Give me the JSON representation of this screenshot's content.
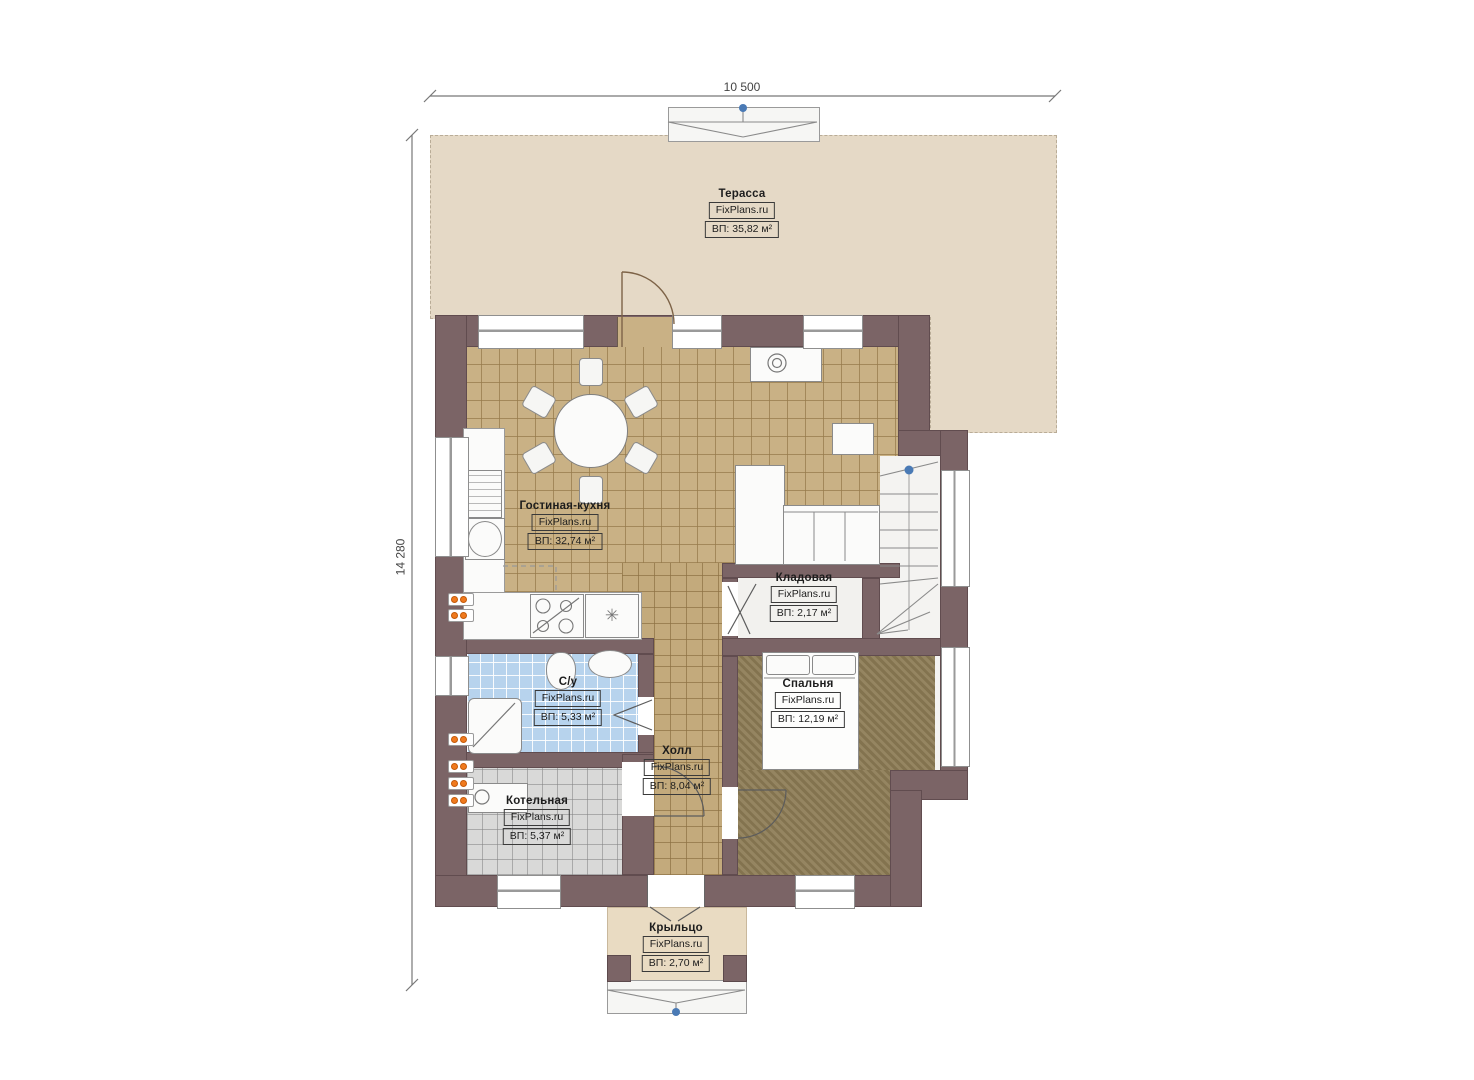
{
  "dimensions": {
    "top": "10 500",
    "left": "14 280"
  },
  "watermark": "FixPlans.ru",
  "rooms": {
    "terrace": {
      "name": "Терасса",
      "area": "ВП: 35,82 м²"
    },
    "living_kitchen": {
      "name": "Гостиная-кухня",
      "area": "ВП: 32,74 м²"
    },
    "storage": {
      "name": "Кладовая",
      "area": "ВП: 2,17 м²"
    },
    "bathroom": {
      "name": "С/у",
      "area": "ВП: 5,33 м²"
    },
    "hall": {
      "name": "Холл",
      "area": "ВП: 8,04 м²"
    },
    "bedroom": {
      "name": "Спальня",
      "area": "ВП: 12,19 м²"
    },
    "boiler": {
      "name": "Котельная",
      "area": "ВП: 5,37 м²"
    },
    "porch": {
      "name": "Крыльцо",
      "area": "ВП: 2,70 м²"
    }
  },
  "colors": {
    "wall": "#7b6466",
    "terrace_floor": "#e5d9c6",
    "tile_floor": "#c9b185",
    "corridor_floor": "#c3aa7c",
    "bedroom_floor": "#8d7c55",
    "bathroom_floor": "#b7d3ed",
    "boiler_floor": "#d9d9d8",
    "porch_floor": "#e9dbc2",
    "marker_orange": "#f07a1e",
    "node_blue": "#4a7ab5"
  }
}
